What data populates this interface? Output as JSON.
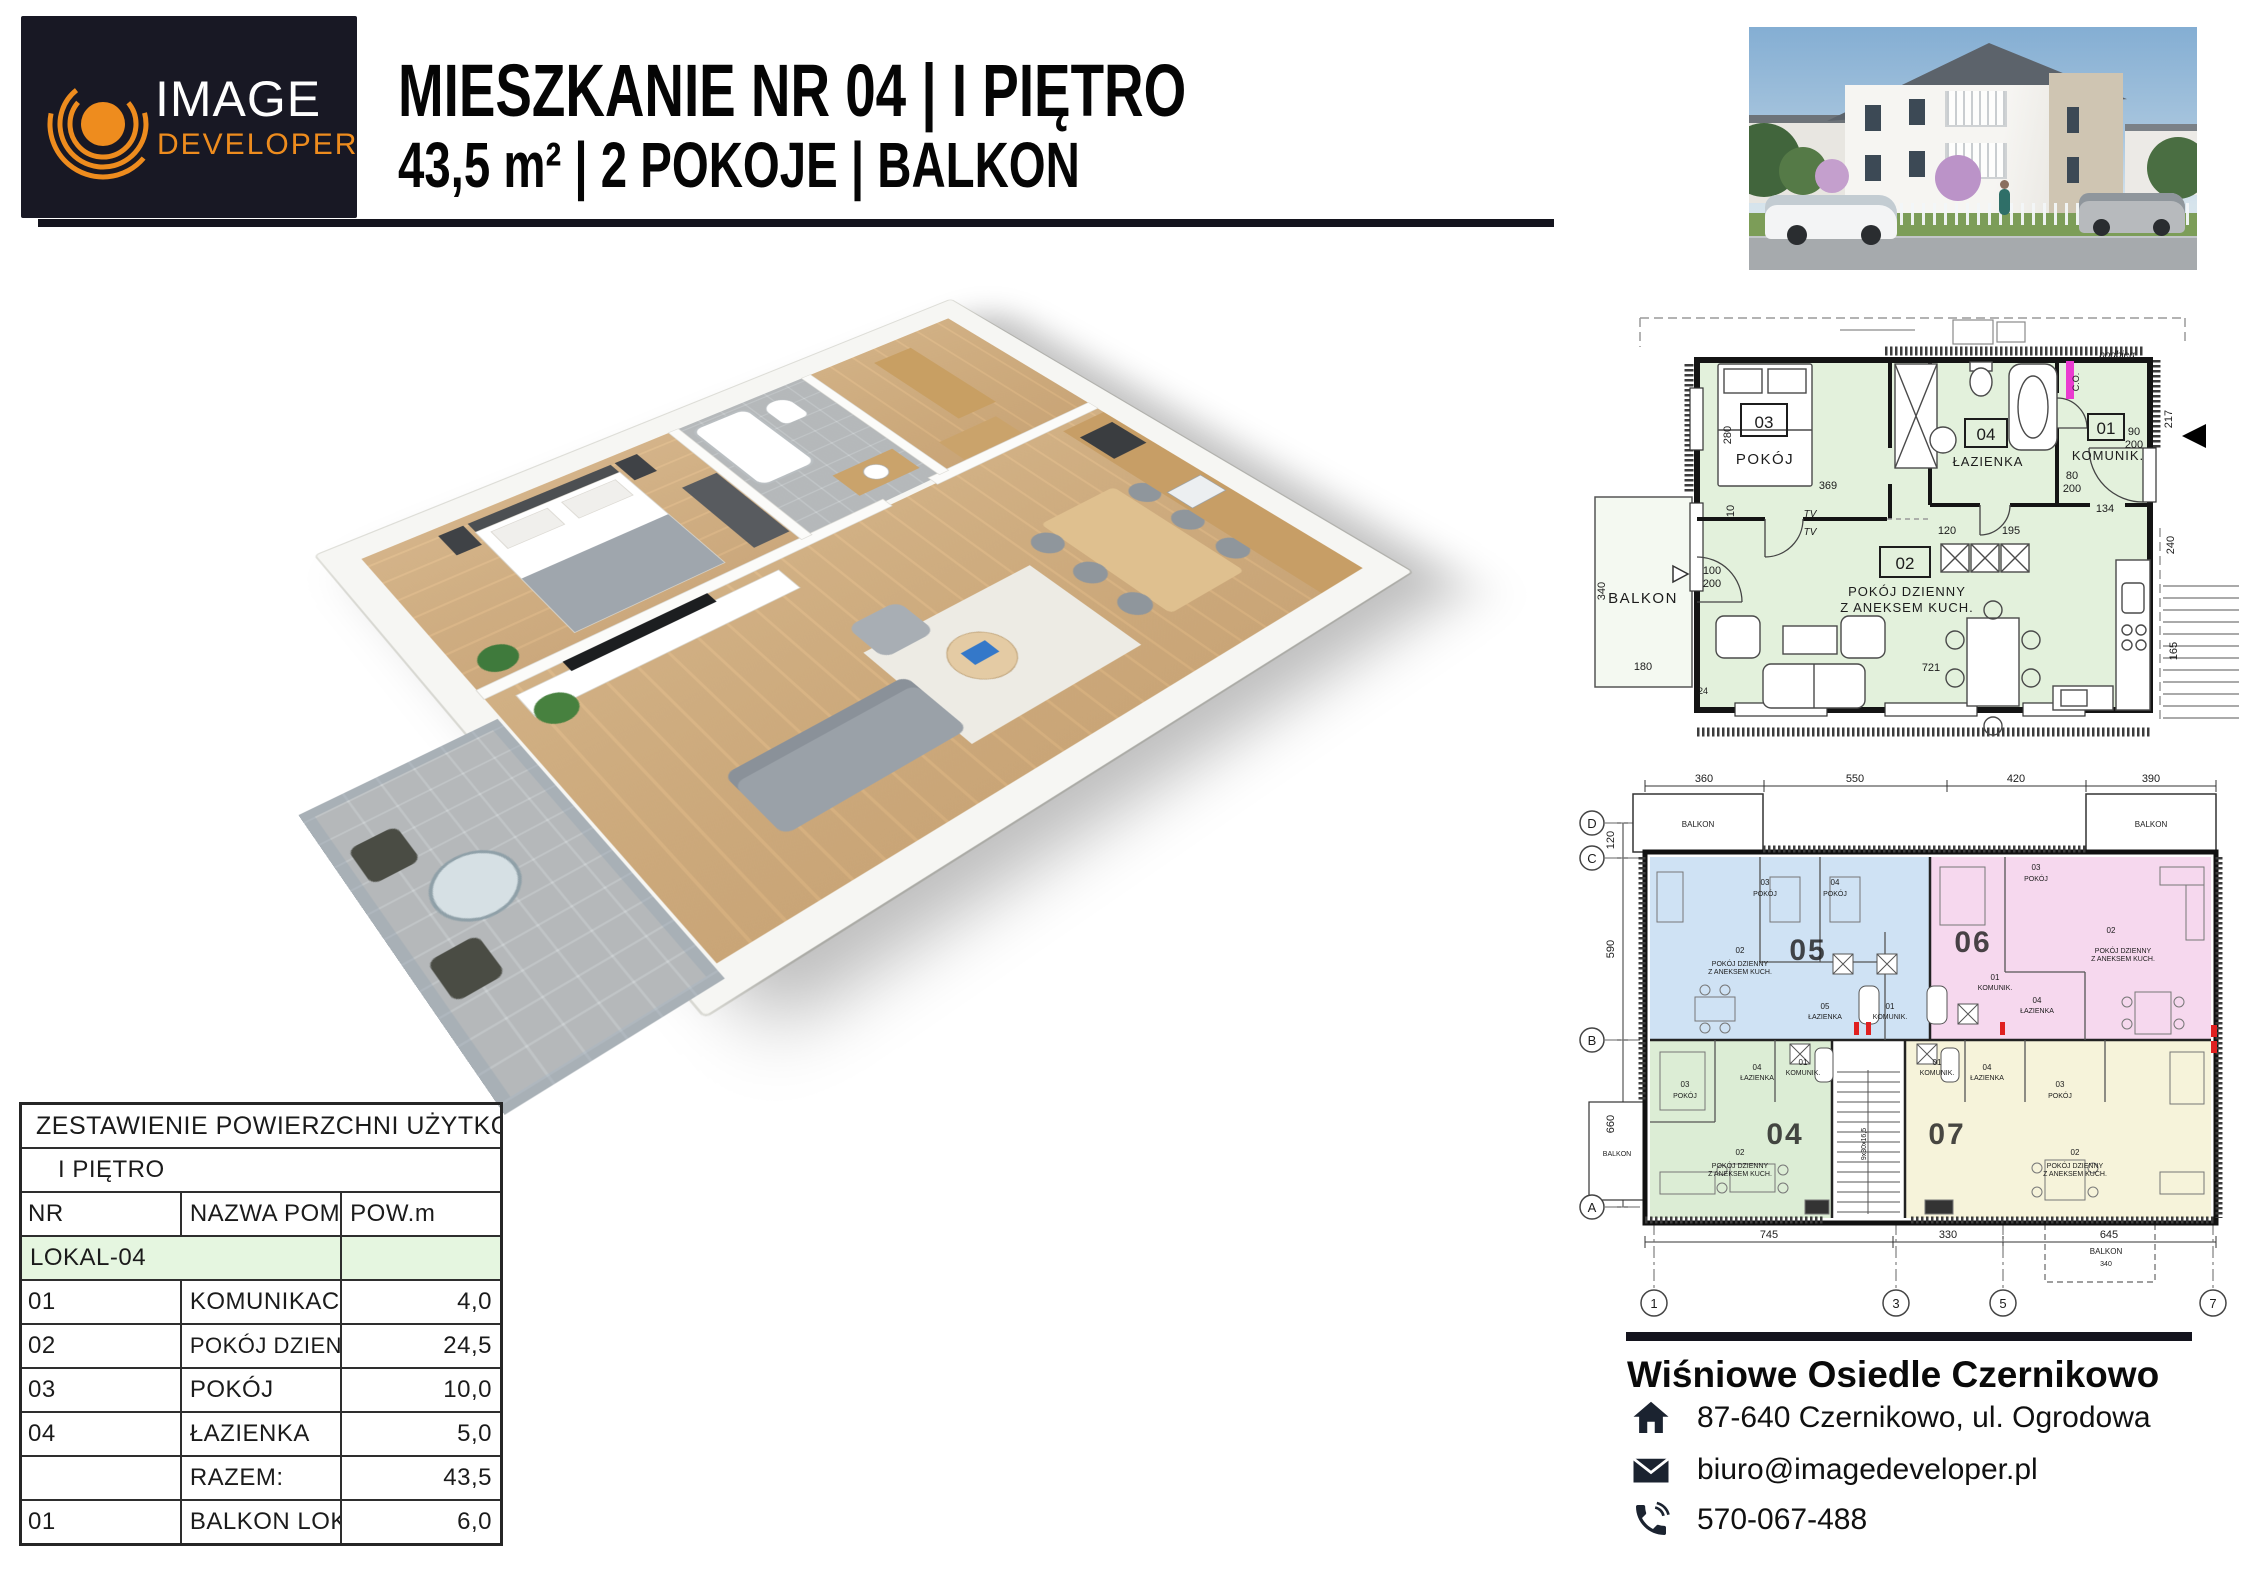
{
  "logo": {
    "line1": "IMAGE",
    "line2": "DEVELOPER"
  },
  "header": {
    "title": "MIESZKANIE NR 04 | I PIĘTRO",
    "subtitle": "43,5 m² | 2 POKOJE | BALKON"
  },
  "colors": {
    "accent_orange": "#ee8c1e",
    "navy": "#181824",
    "plan_green": "#e3f1dc",
    "unit_blue": "#cfe2f4",
    "unit_pink": "#f6d8ee",
    "unit_green": "#dcedd5",
    "unit_yellow": "#f6f3da",
    "table_green": "#e5f6e0",
    "co_marker": "#ea3bd0"
  },
  "plan_apartment": {
    "balkon": "BALKON",
    "podbieg": "podbieg",
    "co": "C.O.",
    "tv": "TV",
    "rooms": {
      "r03": {
        "num": "03",
        "name": "POKÓJ"
      },
      "r04": {
        "num": "04",
        "name": "ŁAZIENKA"
      },
      "r01": {
        "num": "01",
        "name": "KOMUNIK."
      },
      "r02": {
        "num": "02",
        "name1": "POKÓJ DZIENNY",
        "name2": "Z ANEKSEM KUCH."
      }
    },
    "dims": {
      "d280": "280",
      "d369": "369",
      "d340": "340",
      "d180": "180",
      "d721": "721",
      "d120": "120",
      "d195": "195",
      "d134": "134",
      "d217": "217",
      "d240": "240",
      "d165": "165",
      "d24": "24",
      "d10": "10",
      "w100": "100",
      "w90": "90",
      "w80": "80",
      "h200": "200"
    }
  },
  "plan_floor": {
    "top_dims": [
      "360",
      "550",
      "420",
      "390"
    ],
    "left_dims": [
      "120",
      "590",
      "660"
    ],
    "bottom_dims": [
      "745",
      "330",
      "645"
    ],
    "grid_rows": [
      "D",
      "C",
      "B",
      "A"
    ],
    "grid_cols": [
      "1",
      "3",
      "5",
      "7"
    ],
    "balkon": "BALKON",
    "dim340": "340",
    "stairs": "9x30x16,5",
    "unit_nums": {
      "u05": "05",
      "u06": "06",
      "u04": "04",
      "u07": "07"
    },
    "shared": {
      "n01": "01",
      "n02": "02",
      "n03": "03",
      "n04": "04",
      "n05": "05",
      "pokoj": "POKÓJ",
      "lazienka": "ŁAZIENKA",
      "komunik": "KOMUNIK.",
      "living1": "POKÓJ DZIENNY",
      "living2": "Z ANEKSEM KUCH."
    }
  },
  "table": {
    "title": "ZESTAWIENIE POWIERZCHNI UŻYTKOWYCH",
    "floor": "I PIĘTRO",
    "col_nr": "NR",
    "col_name": "NAZWA POM.",
    "col_area": "POW.m",
    "group": "LOKAL-04",
    "rows": [
      {
        "nr": "01",
        "name": "KOMUNIKACJA",
        "area": "4,0"
      },
      {
        "nr": "02",
        "name": "POKÓJ DZIENNY Z ANEKSEM KUCHENNYM",
        "area": "24,5"
      },
      {
        "nr": "03",
        "name": "POKÓJ",
        "area": "10,0"
      },
      {
        "nr": "04",
        "name": "ŁAZIENKA",
        "area": "5,0"
      },
      {
        "nr": "",
        "name": "RAZEM:",
        "area": "43,5"
      },
      {
        "nr": "01",
        "name": "BALKON LOKAL-04",
        "area": "6,0"
      }
    ]
  },
  "contact": {
    "name": "Wiśniowe Osiedle Czernikowo",
    "address": "87-640 Czernikowo, ul. Ogrodowa",
    "email": "biuro@imagedeveloper.pl",
    "phone": "570-067-488"
  }
}
